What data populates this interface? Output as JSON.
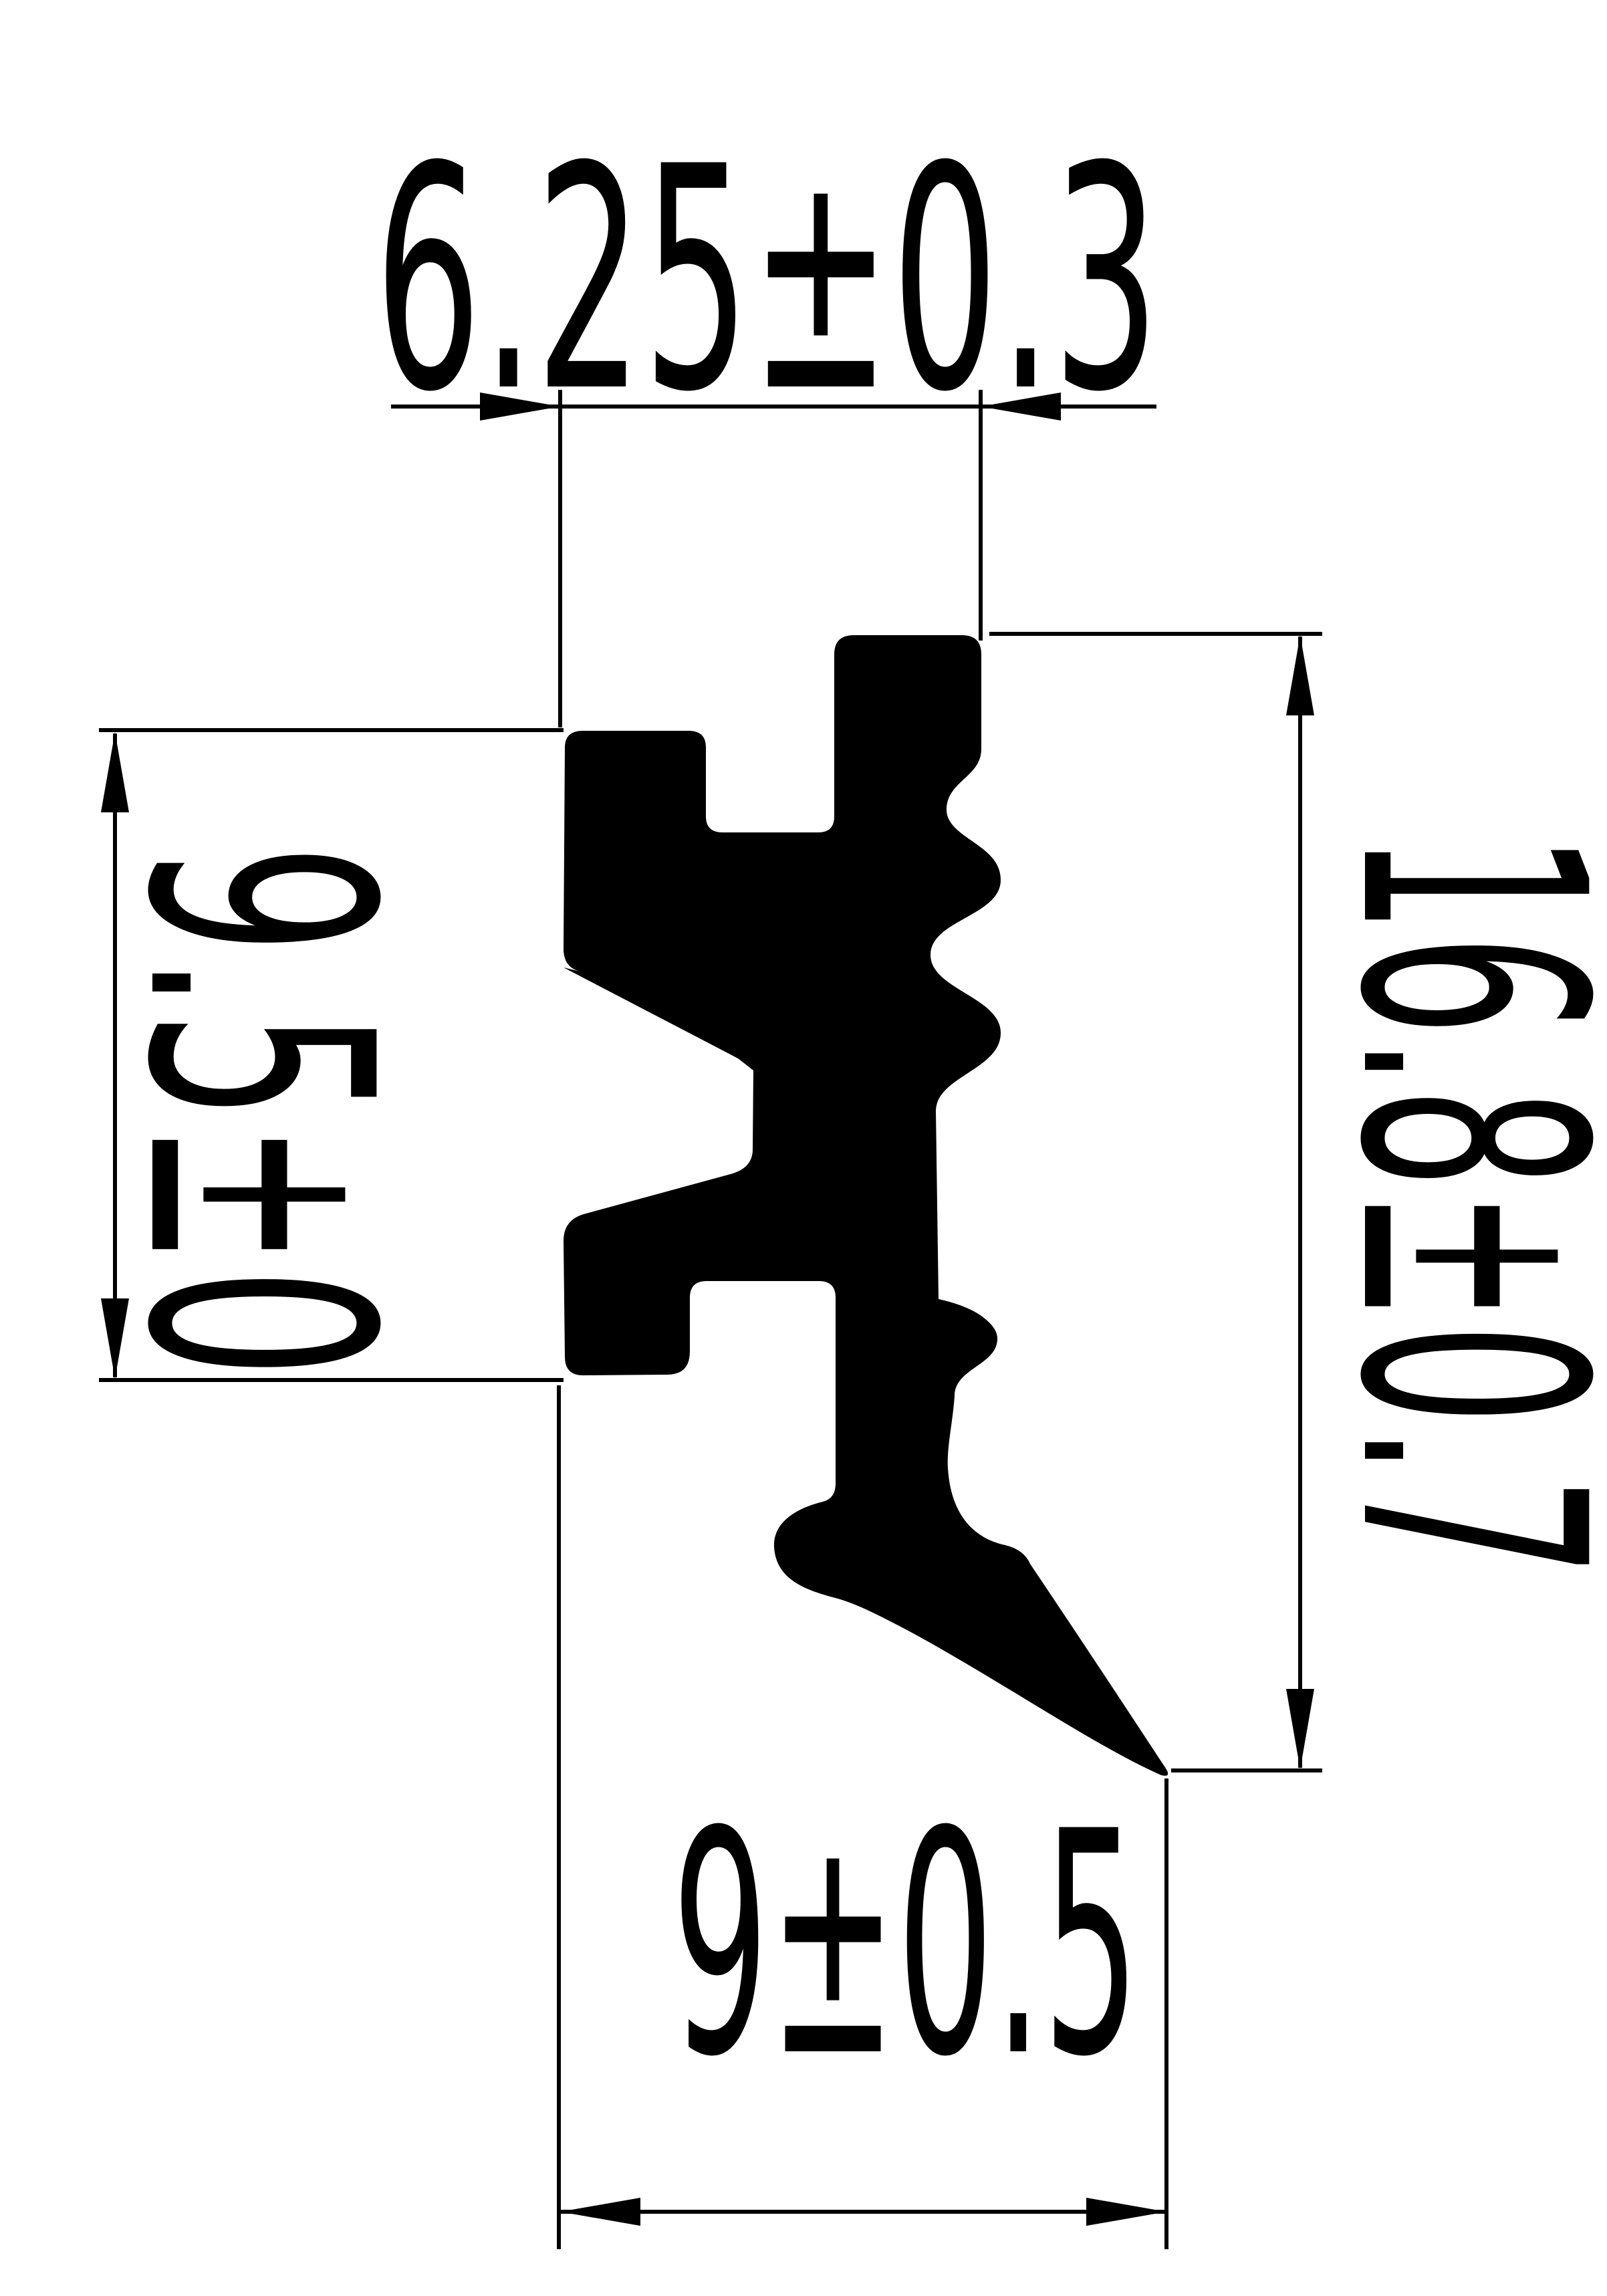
{
  "drawing": {
    "kind": "technical-profile-cross-section",
    "background_color": "#ffffff",
    "line_color": "#000000",
    "profile_fill": "#000000",
    "dimensions": {
      "top": {
        "label": "6.25±0.3",
        "value": 6.25,
        "tolerance": 0.3,
        "orientation": "horizontal",
        "arrow_style": "outside"
      },
      "left": {
        "label": "9.5±0",
        "value": 9.5,
        "tolerance": 0,
        "orientation": "vertical",
        "arrow_style": "inside"
      },
      "right": {
        "label": "16.8±0.7",
        "value": 16.8,
        "tolerance": 0.7,
        "orientation": "vertical",
        "arrow_style": "inside"
      },
      "bottom": {
        "label": "9±0.5",
        "value": 9,
        "tolerance": 0.5,
        "orientation": "horizontal",
        "arrow_style": "inside"
      }
    }
  }
}
